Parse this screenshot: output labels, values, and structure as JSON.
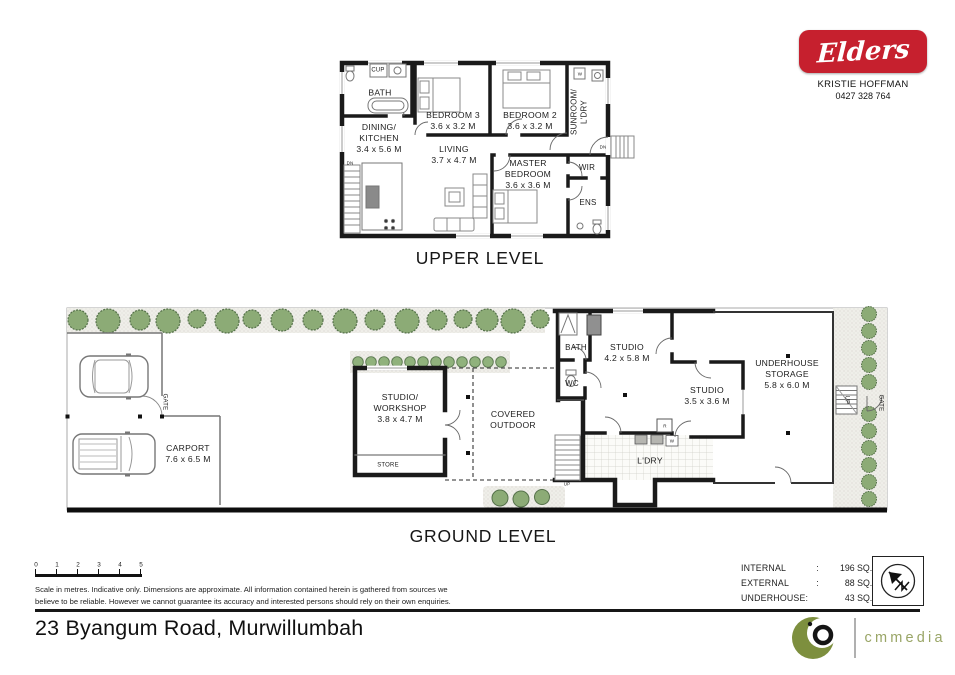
{
  "branding": {
    "logo_text": "Elders",
    "agent_name": "KRISTIE HOFFMAN",
    "agent_phone": "0427 328 764"
  },
  "upper": {
    "title": "UPPER LEVEL",
    "bath": "BATH",
    "cup": "CUP",
    "dining_l1": "DINING/",
    "dining_l2": "KITCHEN",
    "dining_dims": "3.4 x 5.6 M",
    "bed3": "BEDROOM 3",
    "bed3_dims": "3.6 x 3.2 M",
    "bed2": "BEDROOM 2",
    "bed2_dims": "3.6 x 3.2 M",
    "sunroom_l1": "SUNROOM/",
    "sunroom_l2": "L'DRY",
    "living": "LIVING",
    "living_dims": "3.7 x 4.7 M",
    "master_l1": "MASTER",
    "master_l2": "BEDROOM",
    "master_dims": "3.6 x 3.6 M",
    "wir": "WIR",
    "ens": "ENS",
    "dn": "DN",
    "w": "W"
  },
  "ground": {
    "title": "GROUND LEVEL",
    "carport": "CARPORT",
    "carport_dims": "7.6 x 6.5 M",
    "gate": "GATE",
    "workshop_l1": "STUDIO/",
    "workshop_l2": "WORKSHOP",
    "workshop_dims": "3.8 x 4.7 M",
    "store": "STORE",
    "covered_l1": "COVERED",
    "covered_l2": "OUTDOOR",
    "bath": "BATH",
    "wc": "WC",
    "studio_main": "STUDIO",
    "studio_main_dims": "4.2 x 5.8 M",
    "studio_small": "STUDIO",
    "studio_small_dims": "3.5 x 3.6 M",
    "ldry": "L'DRY",
    "underhouse_l1": "UNDERHOUSE",
    "underhouse_l2": "STORAGE",
    "underhouse_dims": "5.8 x 6.0 M",
    "up": "UP",
    "r": "R",
    "w": "W"
  },
  "footer": {
    "scale_ticks": [
      "0",
      "1",
      "2",
      "3",
      "4",
      "5"
    ],
    "disclaimer_l1": "Scale in metres.  Indicative only.  Dimensions are approximate.  All information contained herein is gathered from sources we",
    "disclaimer_l2": "believe to be reliable.  However we cannot guarantee its accuracy and interested persons should rely on their own enquiries.",
    "areas": [
      {
        "label": "INTERNAL",
        "colon": ":",
        "value": "196 SQ.M."
      },
      {
        "label": "EXTERNAL",
        "colon": ":",
        "value": "88 SQ.M."
      },
      {
        "label": "UNDERHOUSE:",
        "colon": "",
        "value": "43 SQ.M."
      }
    ],
    "address": "23 Byangum Road, Murwillumbah",
    "media_brand": "cmmedia"
  },
  "colors": {
    "elders_red": "#c6202e",
    "tree_green": "#8cab76",
    "media_olive": "#7d8f3e"
  }
}
